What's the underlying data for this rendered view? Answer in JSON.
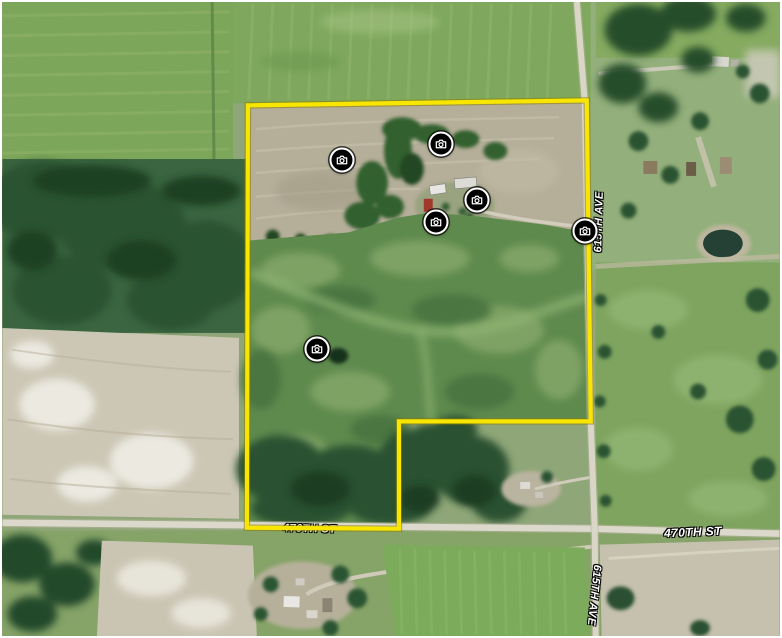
{
  "map": {
    "boundary": {
      "color": "#f8e600",
      "edge_color": "#8a7c00"
    },
    "label_color": "#ffffff",
    "road_labels": [
      {
        "id": "470th-st-west",
        "text": "470TH ST"
      },
      {
        "id": "470th-st-east",
        "text": "470TH ST"
      },
      {
        "id": "615th-ave-north",
        "text": "615TH AVE"
      },
      {
        "id": "615th-ave-south",
        "text": "615TH AVE"
      }
    ],
    "photo_markers": [
      {
        "id": "photo-1",
        "x": 340,
        "y": 158
      },
      {
        "id": "photo-2",
        "x": 439,
        "y": 142
      },
      {
        "id": "photo-3",
        "x": 475,
        "y": 198
      },
      {
        "id": "photo-4",
        "x": 434,
        "y": 220
      },
      {
        "id": "photo-5",
        "x": 583,
        "y": 229
      },
      {
        "id": "photo-6",
        "x": 315,
        "y": 347
      }
    ],
    "marker_icon": "camera-icon"
  }
}
